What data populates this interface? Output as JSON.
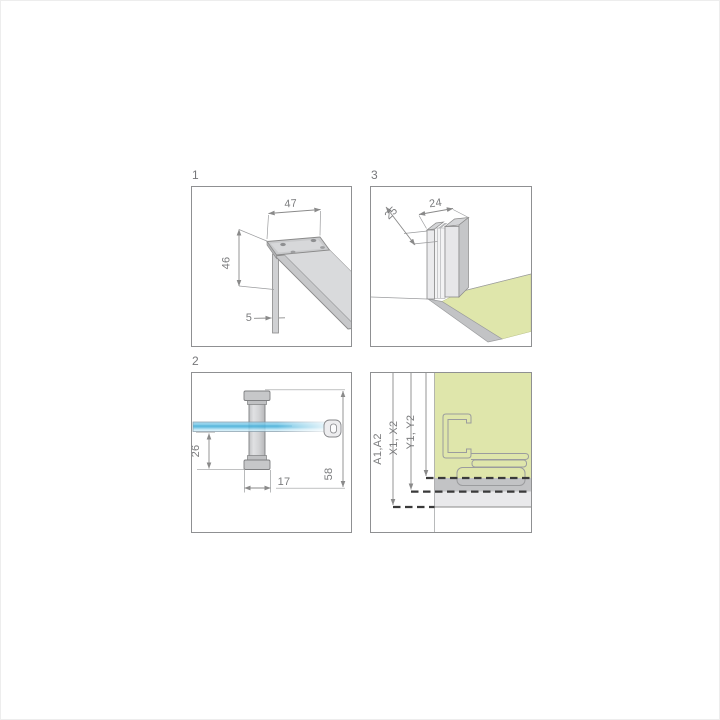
{
  "figure": {
    "title": "shower enclosure mounting detail diagram",
    "panel1": {
      "number": "1",
      "dim_width": "47",
      "dim_height": "46",
      "dim_glass": "5"
    },
    "panel2": {
      "number": "2",
      "dim_drop": "26",
      "dim_knob": "17",
      "dim_total": "58"
    },
    "panel3": {
      "number": "3",
      "dim_depth": "25",
      "dim_width": "24"
    },
    "panel4": {
      "label_a": "A1,A2",
      "label_x": "X1, X2",
      "label_y": "Y1, Y2"
    },
    "colors": {
      "tray_green": "#dfe6ab",
      "glass_blue": "#5fbfe3",
      "metal_gray": "#c9cacc",
      "line_gray": "#8a8a8a",
      "dash_dark": "#3a3a3a"
    }
  }
}
